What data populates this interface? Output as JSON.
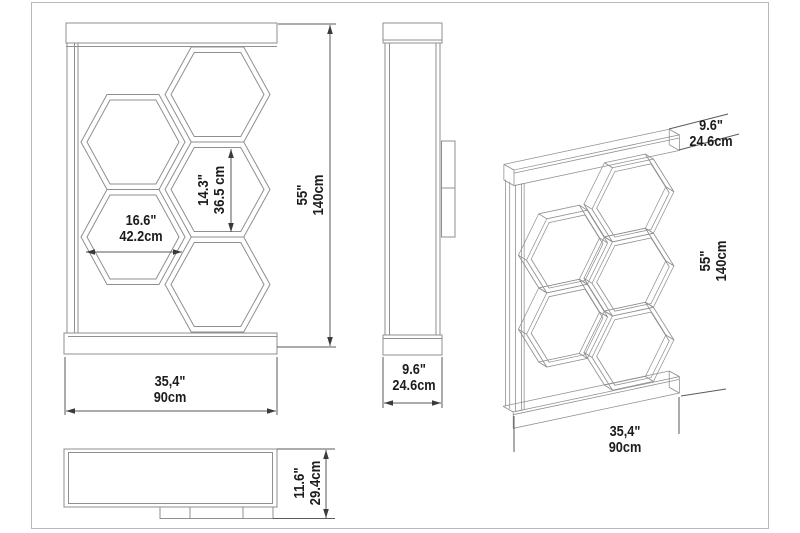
{
  "drawing": {
    "subject": "honeycomb-shelf-technical-drawing",
    "colors": {
      "background": "#ffffff",
      "frame": "#b8b8b8",
      "object_line": "#8f8f8f",
      "dimension_line": "#5a5a5a",
      "text": "#1c1c1c"
    },
    "views": {
      "front": {
        "width": {
          "inches": "35,4\"",
          "metric": "90cm"
        },
        "height": {
          "inches": "55\"",
          "metric": "140cm"
        },
        "cell_width": {
          "inches": "16.6\"",
          "metric": "42.2cm"
        },
        "cell_height": {
          "inches": "14.3\"",
          "metric": "36.5 cm"
        }
      },
      "side": {
        "depth": {
          "inches": "9.6\"",
          "metric": "24.6cm"
        }
      },
      "top": {
        "depth": {
          "inches": "11.6\"",
          "metric": "29.4cm"
        }
      },
      "perspective": {
        "tray_depth": {
          "inches": "9.6\"",
          "metric": "24.6cm"
        },
        "height": {
          "inches": "55\"",
          "metric": "140cm"
        },
        "width": {
          "inches": "35,4\"",
          "metric": "90cm"
        }
      }
    }
  }
}
